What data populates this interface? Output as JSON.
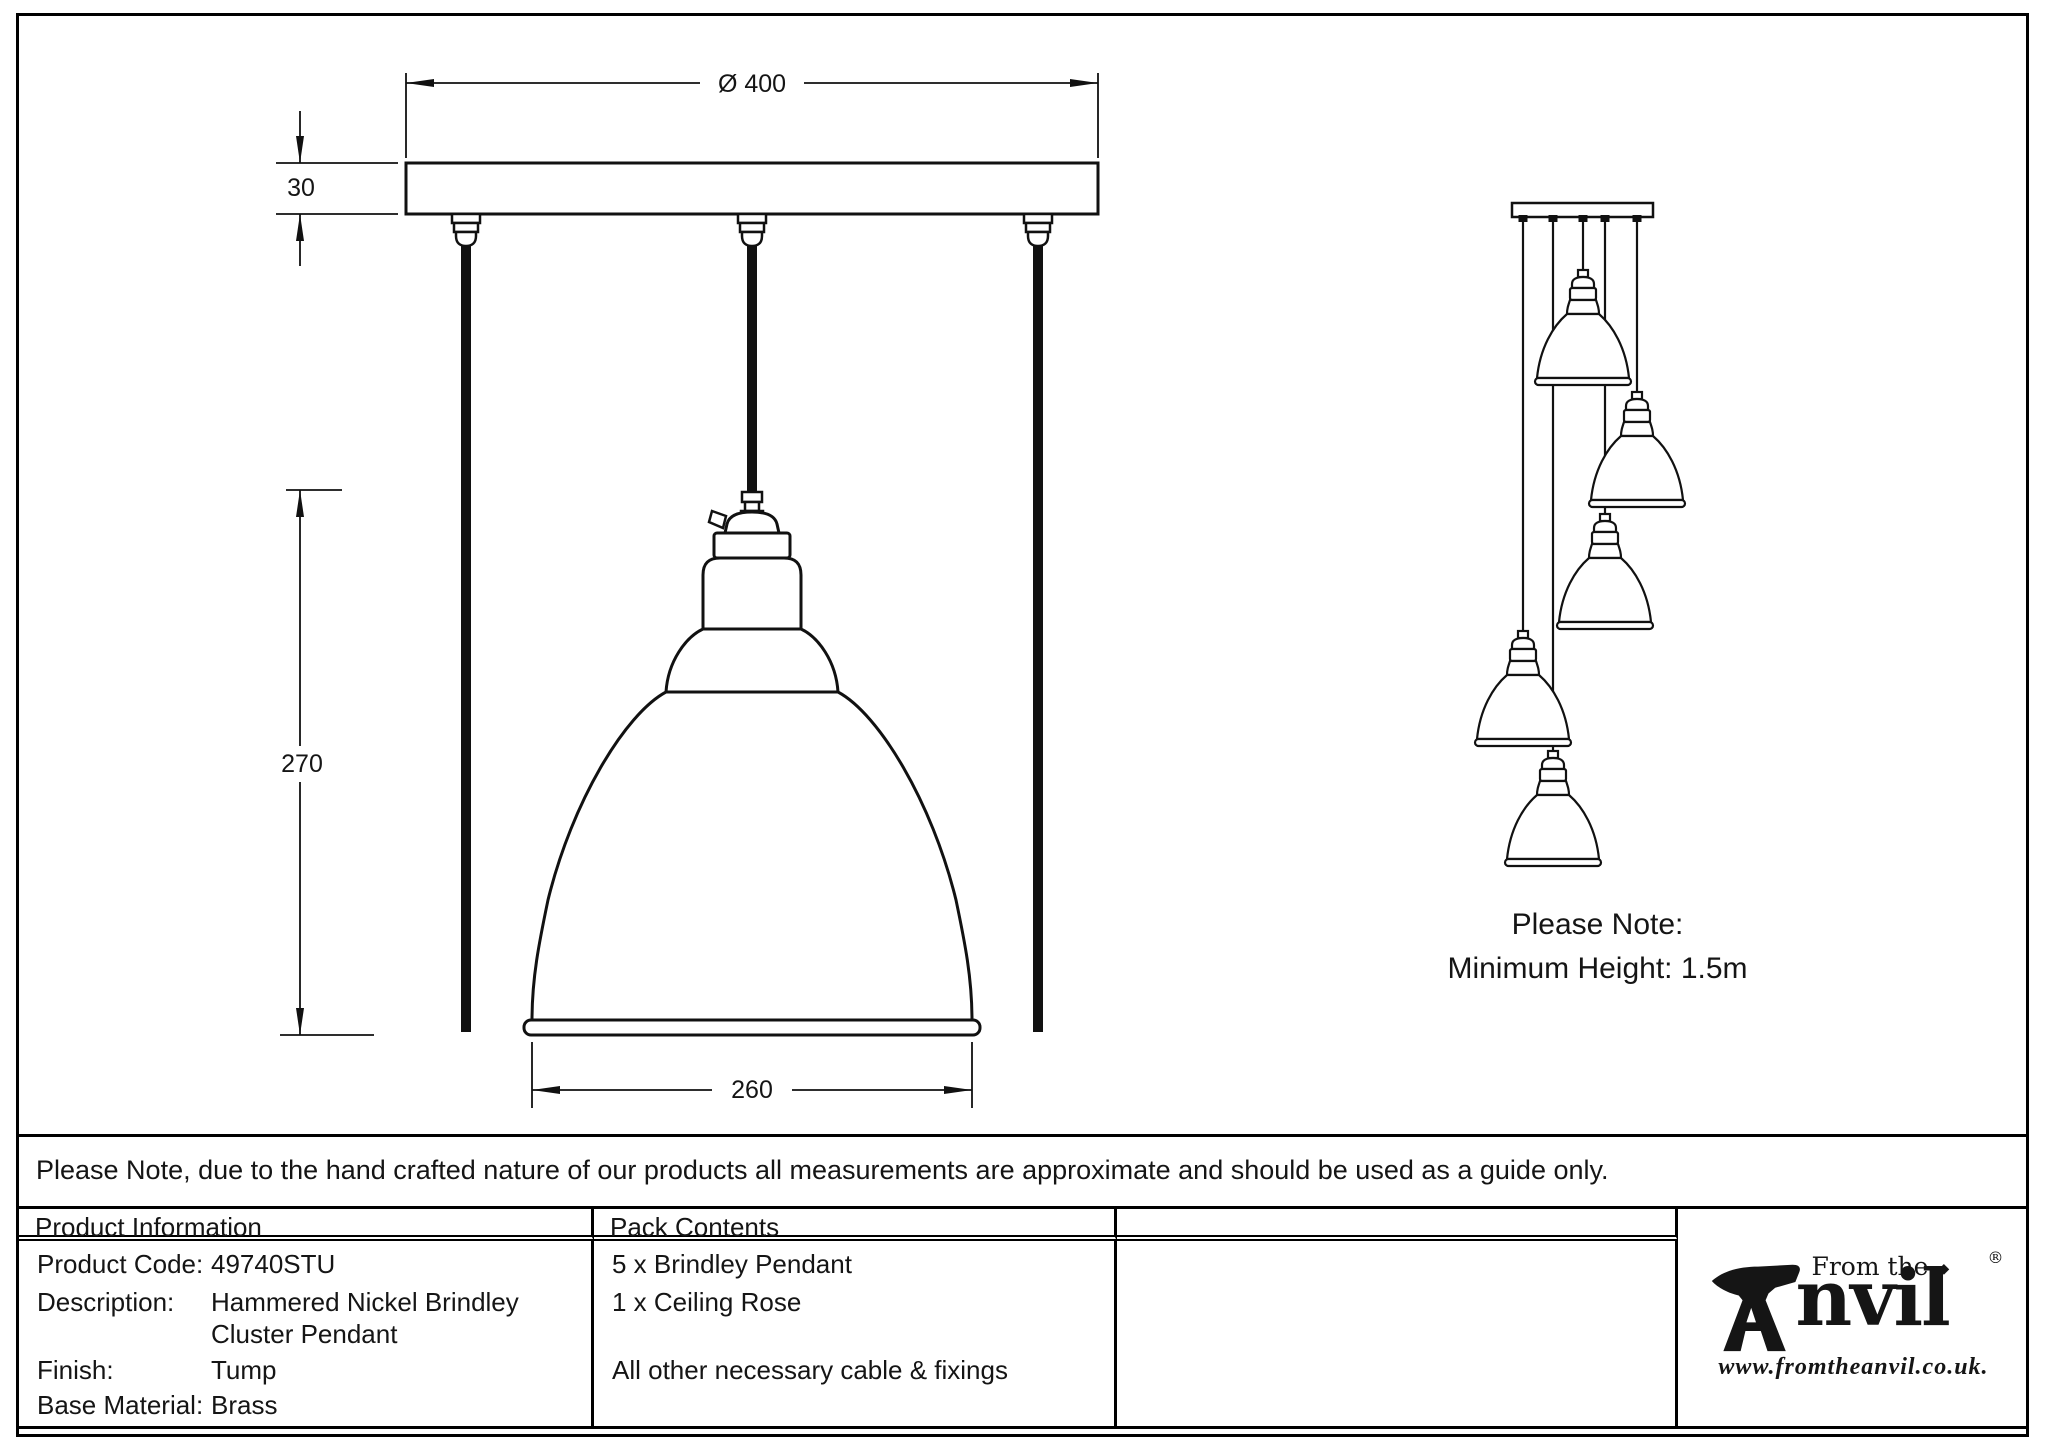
{
  "front_view": {
    "dim_diameter": "Ø 400",
    "dim_plate_thickness": "30",
    "dim_pendant_height": "270",
    "dim_shade_width": "260"
  },
  "cluster_view": {
    "note_line1": "Please Note:",
    "note_line2": "Minimum Height: 1.5m"
  },
  "disclaimer": "Please Note, due to the hand crafted nature of our products all measurements are approximate and should be used as a guide only.",
  "table": {
    "product_info": {
      "header": "Product Information",
      "rows": [
        {
          "label": "Product Code:",
          "value": "49740STU"
        },
        {
          "label": "Description:",
          "value": "Hammered Nickel Brindley"
        },
        {
          "label": "",
          "value": "Cluster Pendant"
        },
        {
          "label": "Finish:",
          "value": "Tump"
        },
        {
          "label": "Base Material:",
          "value": "Brass"
        }
      ]
    },
    "pack_contents": {
      "header": "Pack Contents",
      "items": [
        "5 x Brindley Pendant",
        "1 x Ceiling Rose",
        "All other necessary cable & fixings"
      ]
    }
  },
  "logo": {
    "from_the": "From the",
    "diamond": "◆",
    "wordmark": "nvil",
    "registered": "®",
    "url": "www.fromtheanvil.co.uk."
  }
}
